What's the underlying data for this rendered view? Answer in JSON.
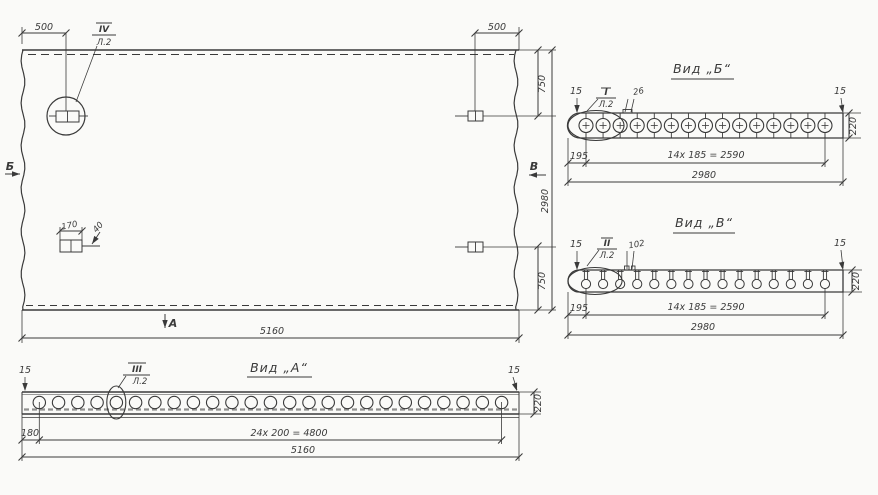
{
  "colors": {
    "ink": "#3a3a3a",
    "paper": "#fafaf8"
  },
  "plan": {
    "dim_top_left": "500",
    "dim_top_right": "500",
    "callout_num": "IV",
    "callout_sheet": "Л.2",
    "marker_left": "Б",
    "marker_right": "В",
    "marker_bottom": "А",
    "dim_right_top": "750",
    "dim_right_overall": "2980",
    "dim_right_bottom": "750",
    "dim_bottom": "5160",
    "detail_dim_width": "170",
    "detail_dim_depth": "40"
  },
  "view_a": {
    "title": "Вид „А“",
    "callout_num": "III",
    "callout_sheet": "Л.2",
    "dim_edge_left": "15",
    "dim_edge_right": "15",
    "dim_thickness": "220",
    "dim_offset": "180",
    "dim_pitch": "24х 200 = 4800",
    "dim_overall": "5160",
    "holes_count": 25
  },
  "view_b": {
    "title": "Вид „Б“",
    "callout_num": "I",
    "callout_sheet": "Л.2",
    "dim_edge_left": "15",
    "dim_edge_right": "15",
    "dim_tab": "26",
    "dim_thickness": "220",
    "dim_offset": "195",
    "dim_pitch": "14х 185 = 2590",
    "dim_overall": "2980",
    "holes_count": 15
  },
  "view_v": {
    "title": "Вид „В“",
    "callout_num": "II",
    "callout_sheet": "Л.2",
    "dim_edge_left": "15",
    "dim_edge_right": "15",
    "dim_tab": "102",
    "dim_thickness": "220",
    "dim_offset": "195",
    "dim_pitch": "14х 185 = 2590",
    "dim_overall": "2980",
    "anchors_count": 15
  }
}
